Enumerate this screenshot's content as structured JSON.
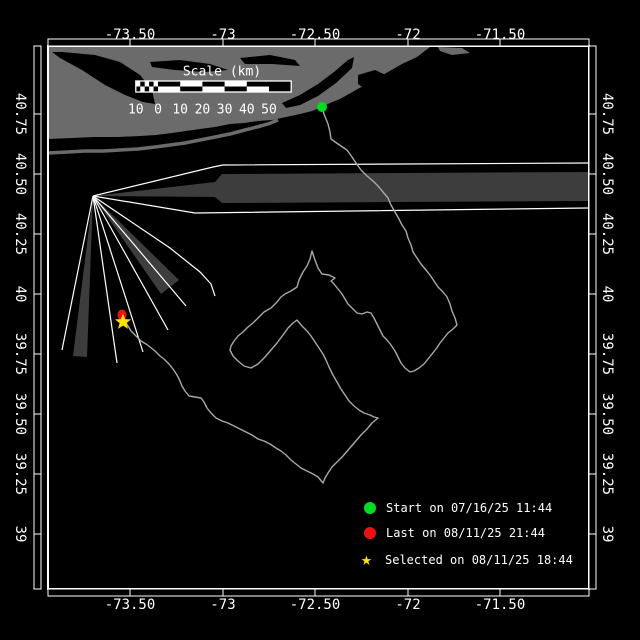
{
  "canvas": {
    "w": 640,
    "h": 640,
    "bg": "#000000"
  },
  "colors": {
    "white": "#ffffff",
    "land": "#6b6b6b",
    "beam": "#3d3d3d",
    "track": "#a9a9a9",
    "start": "#00dd22",
    "last": "#ee1111",
    "selected": "#ffe400",
    "label_text": "#ffffff"
  },
  "frame": {
    "x0": 48,
    "y0": 46,
    "x1": 589,
    "y1": 589,
    "band": 7,
    "lon_ticks": [
      {
        "label": "-73.50",
        "x": 130
      },
      {
        "label": "-73",
        "x": 223
      },
      {
        "label": "-72.50",
        "x": 315
      },
      {
        "label": "-72",
        "x": 408
      },
      {
        "label": "-71.50",
        "x": 500
      }
    ],
    "lat_ticks": [
      {
        "label": "40.75",
        "y": 114
      },
      {
        "label": "40.50",
        "y": 174
      },
      {
        "label": "40.25",
        "y": 234
      },
      {
        "label": "40",
        "y": 294
      },
      {
        "label": "39.75",
        "y": 354
      },
      {
        "label": "39.50",
        "y": 414
      },
      {
        "label": "39.25",
        "y": 474
      },
      {
        "label": "39",
        "y": 534
      }
    ]
  },
  "scale_bar": {
    "title": "Scale (km)",
    "title_cx": 222,
    "title_cy": 72,
    "x": 158,
    "y": 81,
    "h": 11,
    "seg_px": 22.2,
    "fine_cells": 5,
    "labels": [
      "10",
      "0",
      "10",
      "20",
      "30",
      "40",
      "50"
    ],
    "labels_y": 110
  },
  "legend": {
    "text_x": 392,
    "marker_x": 364,
    "rows": [
      {
        "marker": "circle",
        "color_key": "start",
        "label": "Start on 07/16/25 11:44",
        "y": 508
      },
      {
        "marker": "circle",
        "color_key": "last",
        "label": "Last on 08/11/25 21:44",
        "y": 533
      },
      {
        "marker": "star",
        "color_key": "selected",
        "label": "Selected on 08/11/25 18:44",
        "y": 560
      }
    ]
  },
  "markers": {
    "start": {
      "x": 322,
      "y": 107,
      "r": 5
    },
    "last": {
      "x": 122,
      "y": 315,
      "rx": 4.5,
      "ry": 5.5
    },
    "selected": {
      "x": 123,
      "y": 322,
      "r": 8.5
    }
  },
  "land": {
    "main": [
      [
        48,
        47
      ],
      [
        430,
        47
      ],
      [
        417,
        57
      ],
      [
        402,
        64
      ],
      [
        388,
        72
      ],
      [
        372,
        81
      ],
      [
        356,
        90
      ],
      [
        340,
        99
      ],
      [
        330,
        103
      ],
      [
        322,
        107
      ],
      [
        312,
        111
      ],
      [
        300,
        114
      ],
      [
        286,
        117
      ],
      [
        272,
        120
      ],
      [
        258,
        121
      ],
      [
        244,
        123
      ],
      [
        230,
        124
      ],
      [
        215,
        127
      ],
      [
        200,
        129
      ],
      [
        186,
        131
      ],
      [
        172,
        133
      ],
      [
        156,
        135
      ],
      [
        140,
        136
      ],
      [
        118,
        137
      ],
      [
        95,
        137
      ],
      [
        72,
        138
      ],
      [
        48,
        139
      ]
    ],
    "barrier": [
      [
        48,
        153
      ],
      [
        68,
        152
      ],
      [
        85,
        151
      ],
      [
        104,
        151
      ],
      [
        120,
        150
      ],
      [
        138,
        149
      ],
      [
        155,
        147
      ],
      [
        170,
        145
      ],
      [
        185,
        143
      ],
      [
        200,
        140
      ],
      [
        215,
        137
      ],
      [
        230,
        134
      ],
      [
        245,
        130
      ],
      [
        257,
        127
      ],
      [
        268,
        124
      ],
      [
        278,
        120
      ]
    ],
    "spit": [
      [
        438,
        47
      ],
      [
        462,
        48
      ],
      [
        470,
        53
      ],
      [
        452,
        55
      ],
      [
        440,
        51
      ]
    ],
    "water_blobs": [
      [
        [
          62,
          52
        ],
        [
          95,
          55
        ],
        [
          120,
          62
        ],
        [
          140,
          75
        ],
        [
          152,
          90
        ],
        [
          155,
          104
        ],
        [
          143,
          102
        ],
        [
          125,
          95
        ],
        [
          105,
          85
        ],
        [
          82,
          70
        ],
        [
          60,
          58
        ],
        [
          52,
          52
        ]
      ],
      [
        [
          150,
          62
        ],
        [
          180,
          60
        ],
        [
          210,
          64
        ],
        [
          228,
          70
        ],
        [
          205,
          72
        ],
        [
          175,
          70
        ],
        [
          152,
          67
        ]
      ],
      [
        [
          240,
          58
        ],
        [
          270,
          55
        ],
        [
          295,
          60
        ],
        [
          300,
          66
        ],
        [
          272,
          64
        ],
        [
          245,
          64
        ]
      ],
      [
        [
          282,
          103
        ],
        [
          300,
          95
        ],
        [
          318,
          84
        ],
        [
          334,
          72
        ],
        [
          348,
          60
        ],
        [
          354,
          57
        ],
        [
          352,
          68
        ],
        [
          336,
          83
        ],
        [
          318,
          96
        ],
        [
          300,
          105
        ],
        [
          286,
          108
        ]
      ],
      [
        [
          358,
          75
        ],
        [
          375,
          70
        ],
        [
          390,
          77
        ],
        [
          388,
          90
        ],
        [
          370,
          92
        ],
        [
          358,
          84
        ]
      ]
    ]
  },
  "beams": {
    "origin": [
      93,
      196
    ],
    "wedges": [
      [
        [
          93,
          196
        ],
        [
          215,
          182
        ],
        [
          222,
          174
        ],
        [
          588,
          172
        ],
        [
          588,
          201
        ],
        [
          222,
          203
        ],
        [
          215,
          197
        ]
      ],
      [
        [
          93,
          196
        ],
        [
          179,
          280
        ],
        [
          161,
          294
        ]
      ],
      [
        [
          93,
          196
        ],
        [
          87,
          357
        ],
        [
          73,
          356
        ]
      ]
    ],
    "rays": [
      [
        [
          93,
          196
        ],
        [
          213,
          167
        ],
        [
          223,
          165
        ],
        [
          588,
          163
        ]
      ],
      [
        [
          93,
          196
        ],
        [
          195,
          213
        ],
        [
          588,
          208
        ]
      ],
      [
        [
          93,
          196
        ],
        [
          170,
          248
        ],
        [
          200,
          272
        ],
        [
          211,
          284
        ],
        [
          215,
          296
        ]
      ],
      [
        [
          93,
          196
        ],
        [
          186,
          306
        ]
      ],
      [
        [
          93,
          196
        ],
        [
          168,
          330
        ]
      ],
      [
        [
          93,
          196
        ],
        [
          143,
          352
        ]
      ],
      [
        [
          93,
          196
        ],
        [
          117,
          363
        ]
      ],
      [
        [
          93,
          196
        ],
        [
          62,
          350
        ]
      ]
    ]
  },
  "track": [
    [
      322,
      107
    ],
    [
      324,
      114
    ],
    [
      328,
      124
    ],
    [
      330,
      132
    ],
    [
      331,
      139
    ],
    [
      338,
      144
    ],
    [
      347,
      150
    ],
    [
      352,
      157
    ],
    [
      356,
      163
    ],
    [
      361,
      170
    ],
    [
      367,
      176
    ],
    [
      373,
      181
    ],
    [
      378,
      186
    ],
    [
      383,
      192
    ],
    [
      388,
      198
    ],
    [
      391,
      205
    ],
    [
      395,
      212
    ],
    [
      399,
      219
    ],
    [
      402,
      225
    ],
    [
      406,
      231
    ],
    [
      408,
      238
    ],
    [
      411,
      245
    ],
    [
      413,
      252
    ],
    [
      417,
      258
    ],
    [
      421,
      264
    ],
    [
      426,
      270
    ],
    [
      430,
      275
    ],
    [
      434,
      281
    ],
    [
      438,
      287
    ],
    [
      443,
      292
    ],
    [
      447,
      297
    ],
    [
      450,
      304
    ],
    [
      452,
      311
    ],
    [
      455,
      318
    ],
    [
      457,
      325
    ],
    [
      453,
      329
    ],
    [
      448,
      333
    ],
    [
      444,
      338
    ],
    [
      440,
      343
    ],
    [
      436,
      349
    ],
    [
      432,
      354
    ],
    [
      428,
      359
    ],
    [
      424,
      364
    ],
    [
      419,
      368
    ],
    [
      414,
      371
    ],
    [
      410,
      372
    ],
    [
      405,
      368
    ],
    [
      401,
      363
    ],
    [
      398,
      357
    ],
    [
      395,
      351
    ],
    [
      391,
      345
    ],
    [
      387,
      340
    ],
    [
      383,
      336
    ],
    [
      380,
      330
    ],
    [
      377,
      324
    ],
    [
      374,
      318
    ],
    [
      371,
      313
    ],
    [
      367,
      312
    ],
    [
      362,
      314
    ],
    [
      357,
      313
    ],
    [
      352,
      308
    ],
    [
      348,
      304
    ],
    [
      345,
      299
    ],
    [
      342,
      294
    ],
    [
      338,
      289
    ],
    [
      334,
      284
    ],
    [
      331,
      281
    ],
    [
      335,
      278
    ],
    [
      329,
      275
    ],
    [
      322,
      274
    ],
    [
      318,
      268
    ],
    [
      315,
      260
    ],
    [
      312,
      251
    ],
    [
      310,
      259
    ],
    [
      307,
      266
    ],
    [
      303,
      272
    ],
    [
      299,
      280
    ],
    [
      297,
      287
    ],
    [
      291,
      291
    ],
    [
      285,
      294
    ],
    [
      281,
      297
    ],
    [
      277,
      302
    ],
    [
      271,
      308
    ],
    [
      264,
      312
    ],
    [
      258,
      318
    ],
    [
      253,
      323
    ],
    [
      248,
      327
    ],
    [
      243,
      332
    ],
    [
      238,
      336
    ],
    [
      234,
      341
    ],
    [
      231,
      346
    ],
    [
      230,
      350
    ],
    [
      233,
      356
    ],
    [
      238,
      361
    ],
    [
      244,
      366
    ],
    [
      251,
      368
    ],
    [
      258,
      364
    ],
    [
      265,
      357
    ],
    [
      271,
      350
    ],
    [
      277,
      343
    ],
    [
      283,
      335
    ],
    [
      288,
      328
    ],
    [
      293,
      323
    ],
    [
      297,
      320
    ],
    [
      302,
      326
    ],
    [
      307,
      331
    ],
    [
      311,
      336
    ],
    [
      315,
      342
    ],
    [
      319,
      348
    ],
    [
      323,
      354
    ],
    [
      326,
      360
    ],
    [
      329,
      367
    ],
    [
      333,
      375
    ],
    [
      337,
      382
    ],
    [
      341,
      389
    ],
    [
      345,
      395
    ],
    [
      349,
      401
    ],
    [
      354,
      406
    ],
    [
      359,
      410
    ],
    [
      364,
      413
    ],
    [
      370,
      415
    ],
    [
      374,
      417
    ],
    [
      378,
      418
    ],
    [
      372,
      423
    ],
    [
      367,
      429
    ],
    [
      361,
      435
    ],
    [
      355,
      442
    ],
    [
      349,
      449
    ],
    [
      343,
      456
    ],
    [
      337,
      462
    ],
    [
      332,
      467
    ],
    [
      328,
      473
    ],
    [
      325,
      478
    ],
    [
      323,
      483
    ],
    [
      318,
      477
    ],
    [
      313,
      474
    ],
    [
      307,
      471
    ],
    [
      301,
      468
    ],
    [
      296,
      464
    ],
    [
      291,
      460
    ],
    [
      286,
      455
    ],
    [
      281,
      451
    ],
    [
      276,
      448
    ],
    [
      270,
      444
    ],
    [
      264,
      441
    ],
    [
      258,
      439
    ],
    [
      252,
      435
    ],
    [
      246,
      432
    ],
    [
      240,
      429
    ],
    [
      234,
      426
    ],
    [
      228,
      423
    ],
    [
      222,
      421
    ],
    [
      216,
      418
    ],
    [
      211,
      413
    ],
    [
      207,
      408
    ],
    [
      204,
      402
    ],
    [
      201,
      398
    ],
    [
      195,
      397
    ],
    [
      189,
      396
    ],
    [
      185,
      391
    ],
    [
      182,
      386
    ],
    [
      180,
      381
    ],
    [
      177,
      375
    ],
    [
      173,
      369
    ],
    [
      169,
      364
    ],
    [
      164,
      359
    ],
    [
      160,
      356
    ],
    [
      155,
      351
    ],
    [
      150,
      347
    ],
    [
      146,
      344
    ],
    [
      141,
      341
    ],
    [
      136,
      336
    ],
    [
      131,
      331
    ],
    [
      128,
      326
    ],
    [
      125,
      321
    ],
    [
      123,
      318
    ]
  ]
}
